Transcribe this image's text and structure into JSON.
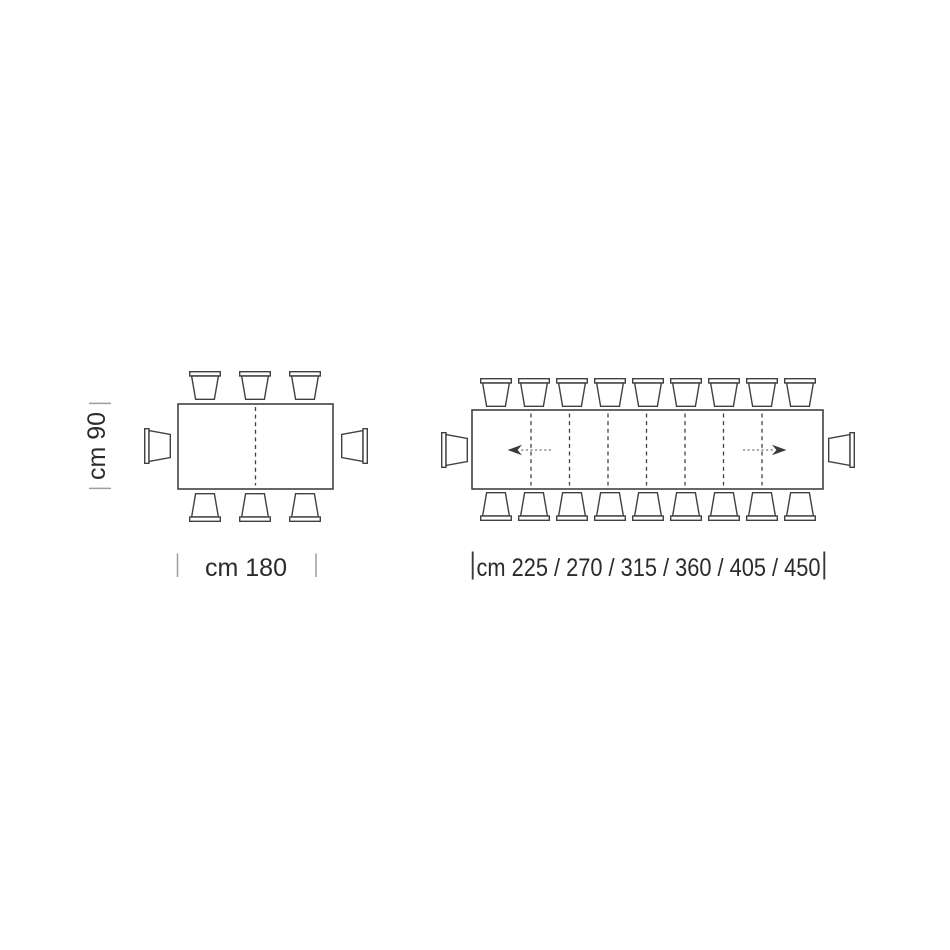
{
  "colors": {
    "background": "#ffffff",
    "line": "#414141",
    "text": "#2b2b2b",
    "tick_gray": "#9c9c9c",
    "tick_dark": "#3a3a3a",
    "fill": "#ffffff"
  },
  "left_diagram": {
    "depth_label": "cm 90",
    "width_label": "cm 180",
    "seats_top": 3,
    "seats_bottom": 3,
    "seats_ends": 2,
    "leaf_lines": 1
  },
  "right_diagram": {
    "width_label": "cm 225 / 270 / 315 / 360 / 405 / 450",
    "seats_top": 9,
    "seats_bottom": 9,
    "seats_ends": 2,
    "leaf_lines": 7,
    "extension_arrows": [
      "left",
      "right"
    ]
  }
}
